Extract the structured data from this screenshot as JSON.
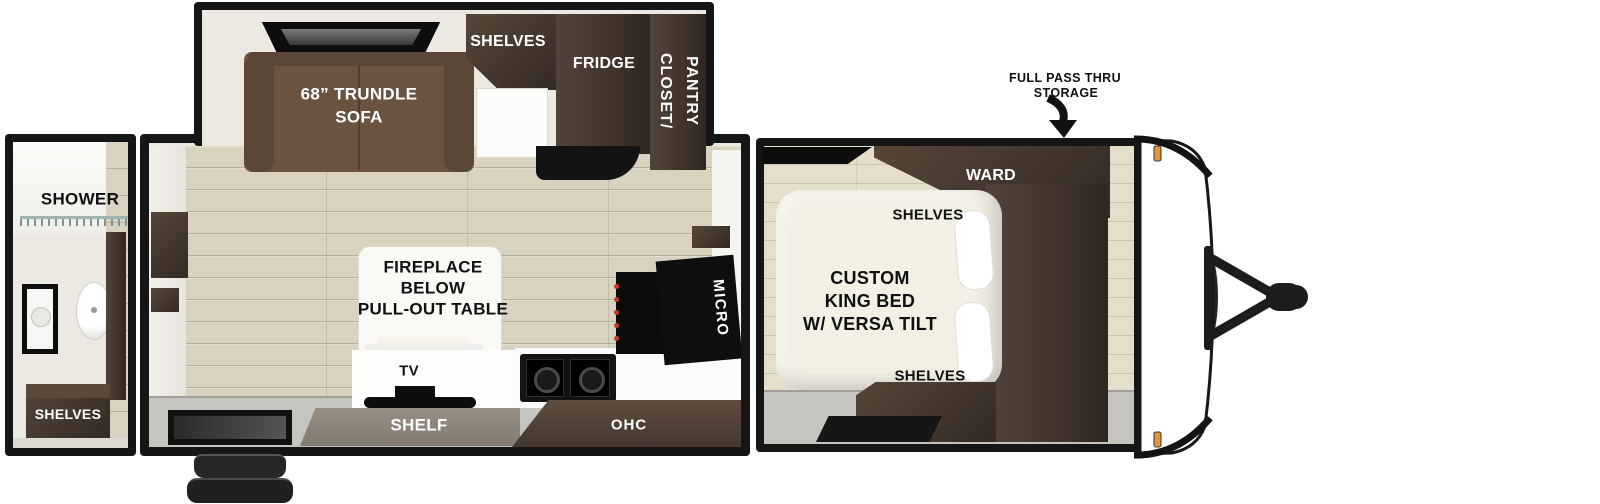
{
  "rear_bath": {
    "shower": "SHOWER",
    "shelves": "SHELVES"
  },
  "living": {
    "sofa_line1": "68” TRUNDLE",
    "sofa_line2": "SOFA",
    "shelves": "SHELVES",
    "fridge": "FRIDGE",
    "closet_line1": "CLOSET/",
    "closet_line2": "PANTRY",
    "fireplace_line1": "FIREPLACE",
    "fireplace_line2": "BELOW",
    "fireplace_line3": "PULL-OUT TABLE",
    "tv": "TV",
    "shelf": "SHELF",
    "ohc": "OHC",
    "micro": "MICRO"
  },
  "bedroom": {
    "ward": "WARD",
    "shelves_top": "SHELVES",
    "bed_line1": "CUSTOM",
    "bed_line2": "KING BED",
    "bed_line3": "W/ VERSA TILT",
    "shelves_bottom": "SHELVES"
  },
  "exterior": {
    "storage_line1": "FULL PASS THRU",
    "storage_line2": "STORAGE"
  },
  "colors": {
    "outline": "#161616",
    "wall_cream": "#ebe9e2",
    "floor_wood": "#d8d2bf",
    "floor_bedroom_wood": "#e4decb",
    "floor_gray": "#c6c4bf",
    "cabinet_wood_dark": "#46392f",
    "shelf_band_taupe": "#8d8279",
    "sofa_brown": "#6b5341",
    "bed_cream": "#f2efe3",
    "flame_orange": "#d98a2e",
    "clearance_marker": "#dd9a3c",
    "label_white": "#ffffff",
    "label_black": "#101010"
  }
}
